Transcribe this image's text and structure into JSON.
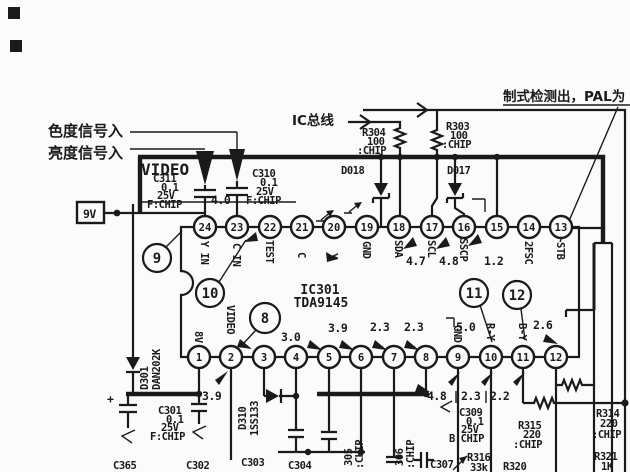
{
  "colors": {
    "ink": "#1a1a1a",
    "paper": "#fbfbfb"
  },
  "annotations": {
    "chroma_in": "色度信号入",
    "luma_in": "亮度信号入",
    "ic_bus": "IC总线",
    "standard_detect": "制式检测出，PAL为"
  },
  "supply": {
    "label": "9V"
  },
  "video_label": "VIDEO",
  "ic": {
    "ref": "IC301",
    "part": "TDA9145"
  },
  "coupling_volt": "4.0",
  "pins_top": [
    {
      "num": "24",
      "name": "Y IN"
    },
    {
      "num": "23",
      "name": "C IN"
    },
    {
      "num": "22",
      "name": "TEST"
    },
    {
      "num": "21",
      "name": "C"
    },
    {
      "num": "20",
      "name": "Y"
    },
    {
      "num": "19",
      "name": "GND"
    },
    {
      "num": "18",
      "name": "SDA",
      "volt": "4.7"
    },
    {
      "num": "17",
      "name": "SCL",
      "volt": "4.8"
    },
    {
      "num": "16",
      "name": "SSCP",
      "volt": "1.2"
    },
    {
      "num": "15",
      "name": ""
    },
    {
      "num": "14",
      "name": "2FSC"
    },
    {
      "num": "13",
      "name": "STB"
    }
  ],
  "pins_bottom": [
    {
      "num": "1",
      "name": "8V"
    },
    {
      "num": "2",
      "name": "VIDEO",
      "volt": "3.9"
    },
    {
      "num": "3",
      "name": ""
    },
    {
      "num": "4",
      "name": "",
      "volt": "3.0"
    },
    {
      "num": "5",
      "name": "",
      "volt": "3.9"
    },
    {
      "num": "6",
      "name": "",
      "volt": "2.3"
    },
    {
      "num": "7",
      "name": "",
      "volt": "2.3"
    },
    {
      "num": "8",
      "name": "",
      "volt": "5.0"
    },
    {
      "num": "9",
      "name": "GND"
    },
    {
      "num": "10",
      "name": "R-Y"
    },
    {
      "num": "11",
      "name": "B-Y",
      "volt": "2.6"
    },
    {
      "num": "12",
      "name": ""
    }
  ],
  "voltages_row": [
    "4.8",
    "2.3",
    "2.2"
  ],
  "callouts": [
    "9",
    "10",
    "8",
    "11",
    "12"
  ],
  "components": {
    "c311": {
      "ref": "C311",
      "value": "0.1",
      "rating": "25V",
      "note": "F:CHIP"
    },
    "c310": {
      "ref": "C310",
      "value": "0.1",
      "rating": "25V",
      "note": "F:CHIP"
    },
    "r304": {
      "ref": "R304",
      "value": "100",
      "note": ":CHIP"
    },
    "r303": {
      "ref": "R303",
      "value": "100",
      "note": ":CHIP"
    },
    "d018": {
      "ref": "D018"
    },
    "d017": {
      "ref": "D017"
    },
    "d301": {
      "ref": "D301",
      "part": "DAN202K"
    },
    "d310": {
      "ref": "D310",
      "part": "1SS133"
    },
    "c301": {
      "ref": "C301",
      "value": "0.1",
      "rating": "25V",
      "note": "F:CHIP"
    },
    "c365": {
      "ref": "C365",
      "polarity": "+"
    },
    "c302": {
      "ref": "C302"
    },
    "c303": {
      "ref": "C303"
    },
    "c304": {
      "ref": "C304"
    },
    "c305": {
      "ref": "305",
      "note": ":CHIP"
    },
    "c306": {
      "ref": "306",
      "note": ":CHIP"
    },
    "c307": {
      "ref": "C307"
    },
    "c309": {
      "ref": "C309",
      "value": "0.1",
      "rating": "25V",
      "note": "B:CHIP"
    },
    "r315": {
      "ref": "R315",
      "value": "220",
      "note": ":CHIP"
    },
    "r314": {
      "ref": "R314",
      "value": "220",
      "note": ":CHIP"
    },
    "r316": {
      "ref": "R316",
      "value": "33k"
    },
    "r320": {
      "ref": "R320"
    },
    "r321": {
      "ref": "R321",
      "value": "1K"
    }
  }
}
